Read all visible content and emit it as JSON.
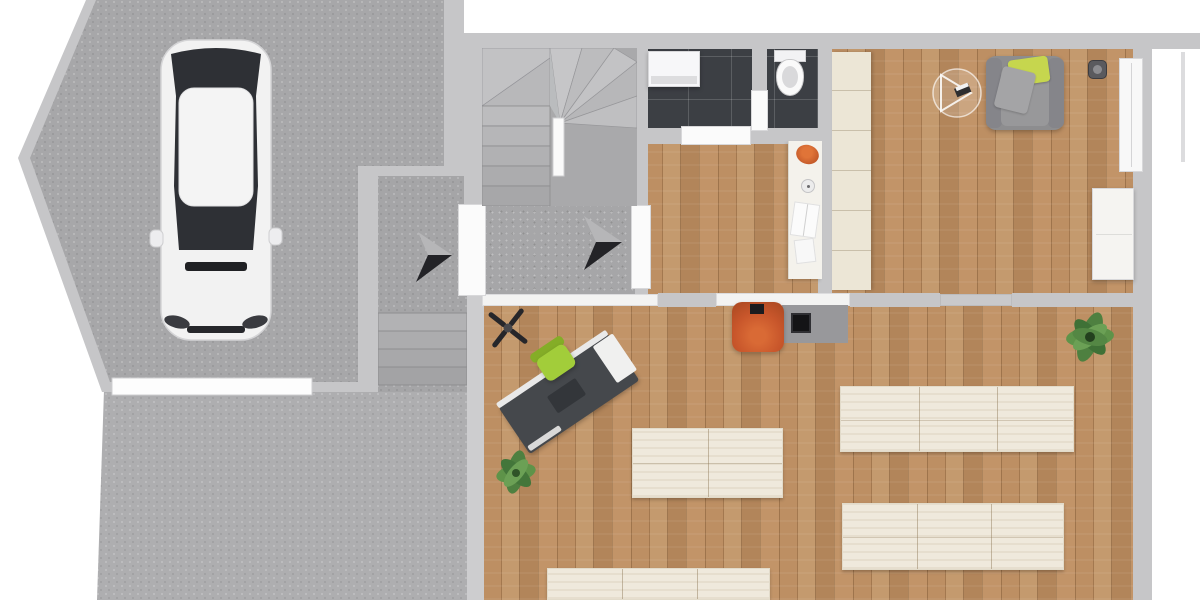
{
  "meta": {
    "kind": "floor-plan-render",
    "view": "top-down",
    "canvas": "1200x600",
    "visible_text": "none"
  },
  "palette": {
    "exterior": "#ffffff",
    "wall": "#c6c6c8",
    "wall_light": "#cdcdcf",
    "garage_floor": "#a7a7a9",
    "hall_floor": "#a6a6a8",
    "walkway": "#a5a5a7",
    "driveway": "#aeaeb0",
    "wood": "#b5875c",
    "tile": "#3c3f44",
    "cream": "#ece6d6",
    "desk": "#45484c",
    "chair_green": "#a2cd3a",
    "pillow_green": "#c6d64e",
    "sofa_gray": "#8d8d8f",
    "orange": "#c8562b",
    "stove": "#141416",
    "plant": "#4e8040",
    "white_item": "#f6f6f6",
    "arrow_dark": "#232327",
    "arrow_light": "#b6b6b8"
  },
  "areas": [
    {
      "id": "garage",
      "floor": "concrete",
      "contains": [
        "car",
        "garage-door"
      ]
    },
    {
      "id": "driveway",
      "floor": "concrete",
      "contains": []
    },
    {
      "id": "entry-walkway",
      "floor": "concrete",
      "contains": [
        "outdoor-steps",
        "entry-arrow"
      ]
    },
    {
      "id": "entry-hall",
      "floor": "concrete",
      "contains": [
        "winder-staircase",
        "newel-post",
        "front-door",
        "direction-arrow"
      ]
    },
    {
      "id": "bathroom",
      "floor": "dark-tile",
      "contains": [
        "washing-machine",
        "toilet",
        "partition-wall",
        "partition-door"
      ]
    },
    {
      "id": "kitchenette",
      "floor": "wood",
      "contains": [
        "counter",
        "orange-basin",
        "round-sink",
        "open-books"
      ]
    },
    {
      "id": "lounge",
      "floor": "wood",
      "contains": [
        "wardrobe-column",
        "armchair",
        "green-pillow",
        "ceiling-lamp",
        "wall-speaker",
        "radiator",
        "sideboard"
      ]
    },
    {
      "id": "open-room",
      "floor": "wood",
      "contains": [
        "ceiling-fan",
        "desk",
        "office-chair",
        "potted-plant-small",
        "potted-plant-large",
        "tub-chair",
        "stove-on-hearth",
        "table-cluster-a",
        "table-cluster-b",
        "table-cluster-c",
        "table-cluster-d"
      ]
    }
  ]
}
